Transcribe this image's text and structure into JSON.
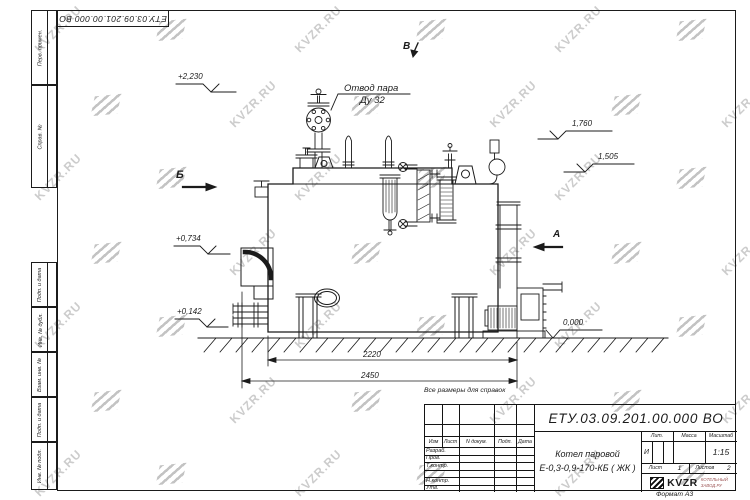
{
  "doc": {
    "corner_stamp": "ЕТУ.03.09.201.00.000  ВО",
    "note": "Все размеры для справок",
    "format_label": "Формат А3"
  },
  "margin_labels": [
    "Перв. примен.",
    "Справ. №",
    "Подп. и дата",
    "Инв. № дубл.",
    "Взам. инв. №",
    "Подп. и дата",
    "Инв. № подл."
  ],
  "title_block": {
    "doc_number": "ЕТУ.03.09.201.00.000  ВО",
    "name_line1": "Котел паровой",
    "name_line2": "Е-0,3-0,9-170-КБ ( ЖК )",
    "change_header": [
      "Изм",
      "Лист",
      "N докум.",
      "Подп.",
      "Дата"
    ],
    "sign_rows": [
      "Разраб.",
      "Пров.",
      "Т.контр.",
      "",
      "Н.контр.",
      "Утв."
    ],
    "lit_label": "Лит.",
    "mass_label": "Масса",
    "scale_label": "Масштаб",
    "lit_value": "И",
    "scale_value": "1:15",
    "sheet_label": "Лист",
    "sheet_value": "1",
    "sheets_label": "Листов",
    "sheets_value": "2",
    "company_name": "KVZR",
    "company_line1": "КОТЕЛЬНЫЙ",
    "company_line2": "ЗАВОД.РУ"
  },
  "drawing": {
    "callout_line1": "Отвод пара",
    "callout_line2": "Ду 32",
    "elev_2230": "+2,230",
    "elev_1760": "1,760",
    "elev_1505": "1,505",
    "elev_0734": "+0,734",
    "elev_0142": "+0,142",
    "elev_0000": "0,000",
    "view_b": "Б",
    "view_v": "В",
    "view_a": "А",
    "dim_inner": "2220",
    "dim_outer": "2450"
  },
  "watermark": {
    "text": "KVZR.RU",
    "text_color": "#cccccc",
    "logo_color": "#c3c3c3",
    "marks": [
      [
        "t",
        28,
        22
      ],
      [
        "l",
        158,
        20
      ],
      [
        "t",
        288,
        22
      ],
      [
        "l",
        418,
        20
      ],
      [
        "t",
        548,
        22
      ],
      [
        "l",
        678,
        20
      ],
      [
        "l",
        93,
        95
      ],
      [
        "t",
        223,
        97
      ],
      [
        "l",
        353,
        95
      ],
      [
        "t",
        483,
        97
      ],
      [
        "l",
        613,
        95
      ],
      [
        "t",
        715,
        97
      ],
      [
        "t",
        28,
        170
      ],
      [
        "l",
        158,
        168
      ],
      [
        "t",
        288,
        170
      ],
      [
        "l",
        418,
        168
      ],
      [
        "t",
        548,
        170
      ],
      [
        "l",
        678,
        168
      ],
      [
        "l",
        93,
        243
      ],
      [
        "t",
        223,
        245
      ],
      [
        "l",
        353,
        243
      ],
      [
        "t",
        483,
        245
      ],
      [
        "l",
        613,
        243
      ],
      [
        "t",
        715,
        245
      ],
      [
        "t",
        28,
        318
      ],
      [
        "l",
        158,
        316
      ],
      [
        "t",
        288,
        318
      ],
      [
        "l",
        418,
        316
      ],
      [
        "t",
        548,
        318
      ],
      [
        "l",
        678,
        316
      ],
      [
        "l",
        93,
        391
      ],
      [
        "t",
        223,
        393
      ],
      [
        "l",
        353,
        391
      ],
      [
        "t",
        483,
        393
      ],
      [
        "l",
        613,
        391
      ],
      [
        "t",
        715,
        393
      ],
      [
        "t",
        28,
        466
      ],
      [
        "l",
        158,
        464
      ],
      [
        "t",
        288,
        466
      ],
      [
        "l",
        418,
        464
      ],
      [
        "t",
        548,
        466
      ],
      [
        "l",
        678,
        464
      ]
    ]
  }
}
